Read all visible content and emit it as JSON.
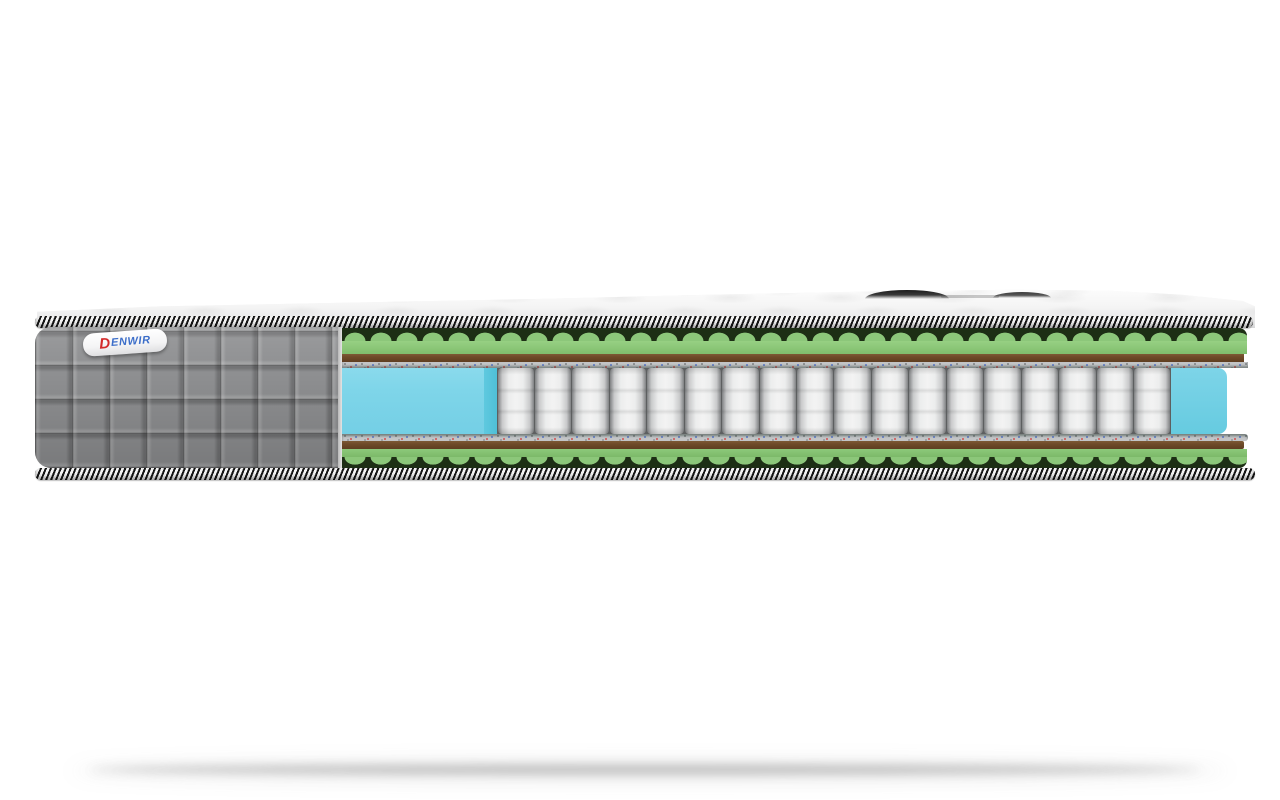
{
  "brand": {
    "initial": "D",
    "name": "ENWIR",
    "full_name": "DENWIR"
  },
  "colors": {
    "background": "#ffffff",
    "cover_gray": "#8f9092",
    "tape_black": "#161616",
    "tape_white": "#f5f5f5",
    "foam_green": "#8cc77a",
    "foam_green_shadow": "#1d2f15",
    "felt_brown": "#6e4a28",
    "spunbond_gray": "#c3c5c7",
    "spring_white": "#f3f3f3",
    "spring_gap": "#5d5f60",
    "support_foam_blue": "#7ed5e9",
    "support_foam_blue_side": "#5fc9df",
    "brand_red": "#d32b2b",
    "brand_blue": "#3c6ec9"
  },
  "mattress": {
    "spring_count": 18,
    "layers_top_to_bottom": [
      "quilted-top-surface",
      "border-tape",
      "wavy-foam-green",
      "felt-brown",
      "spunbond-speckled",
      "pocket-spring-core-with-blue-side-support",
      "spunbond-speckled",
      "felt-brown",
      "wavy-foam-green",
      "border-tape"
    ]
  }
}
